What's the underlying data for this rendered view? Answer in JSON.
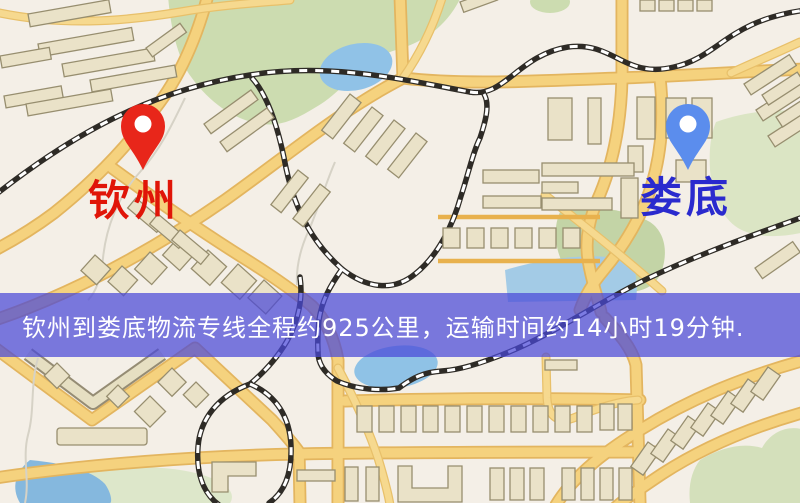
{
  "pins": {
    "origin": {
      "label": "钦州",
      "pin_color": "#e8261a",
      "label_color": "#e01508"
    },
    "destination": {
      "label": "娄底",
      "pin_color": "#5b8ded",
      "label_color": "#2a2ace"
    }
  },
  "banner": {
    "text": "钦州到娄底物流专线全程约925公里，运输时间约14小时19分钟.",
    "bg_color": "#4a48d8",
    "text_color": "#ffffff"
  },
  "map_colors": {
    "land": "#f4efe7",
    "road": "#f5d27e",
    "road_casing": "#e3b55f",
    "railway_dark": "#2e2b26",
    "railway_light": "#ffffff",
    "water": "#90c2e7",
    "park": "#ccdcb0",
    "building_fill": "#eae2c8",
    "building_stroke": "#978e6f"
  }
}
